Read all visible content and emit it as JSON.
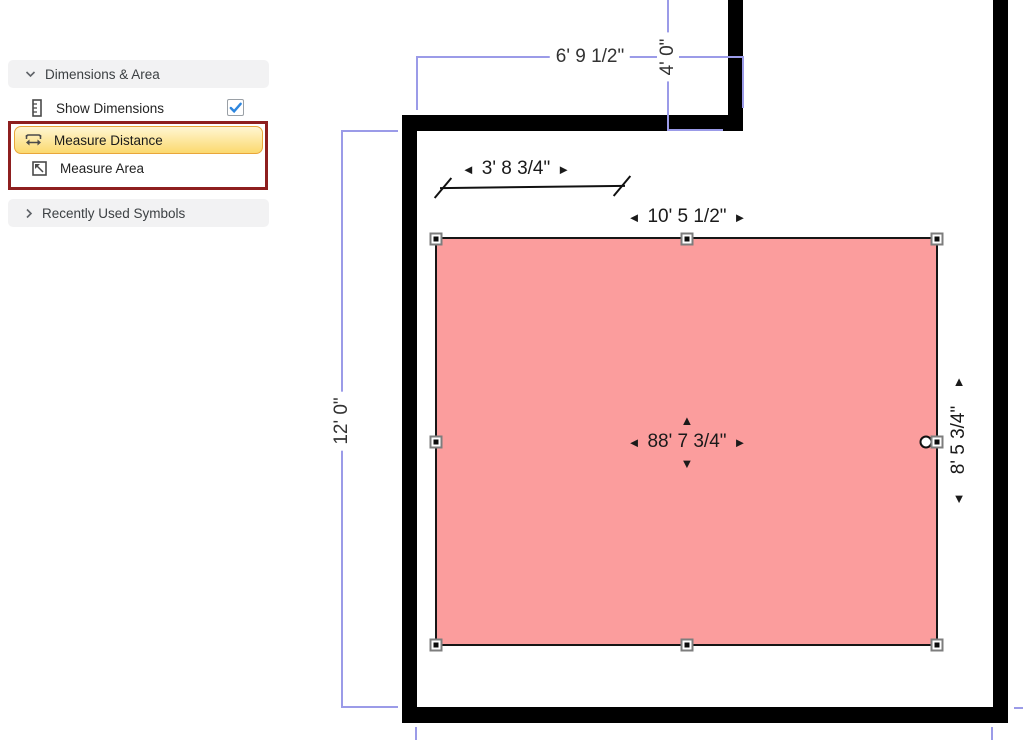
{
  "sidebar": {
    "section_dimensions": {
      "label": "Dimensions & Area"
    },
    "show_dimensions": {
      "label": "Show Dimensions",
      "checked": true
    },
    "measure_distance": {
      "label": "Measure Distance",
      "active": true
    },
    "measure_area": {
      "label": "Measure Area"
    },
    "section_recent": {
      "label": "Recently Used Symbols"
    }
  },
  "canvas": {
    "dimensions": {
      "top_opening_width": "6' 9 1/2\"",
      "notch_height": "4' 0\"",
      "room_height": "12' 0\""
    },
    "measurement_line": {
      "length": "3' 8 3/4\""
    },
    "measured_area": {
      "width": "10' 5 1/2\"",
      "height": "8' 5 3/4\"",
      "area": "88' 7 3/4\""
    },
    "icons": {
      "left": "◄",
      "right": "►",
      "up": "▲",
      "down": "▼"
    }
  },
  "colors": {
    "area_fill": "#fb9d9d",
    "dimension_line": "#9b9be8",
    "wall": "#000000",
    "active_tool_border": "#e9a63a",
    "active_tool_fill": "#fbd96f",
    "annotation_box": "#8e1f1f",
    "checkbox_check": "#2e86de",
    "panel_header_bg": "#f2f2f3"
  }
}
